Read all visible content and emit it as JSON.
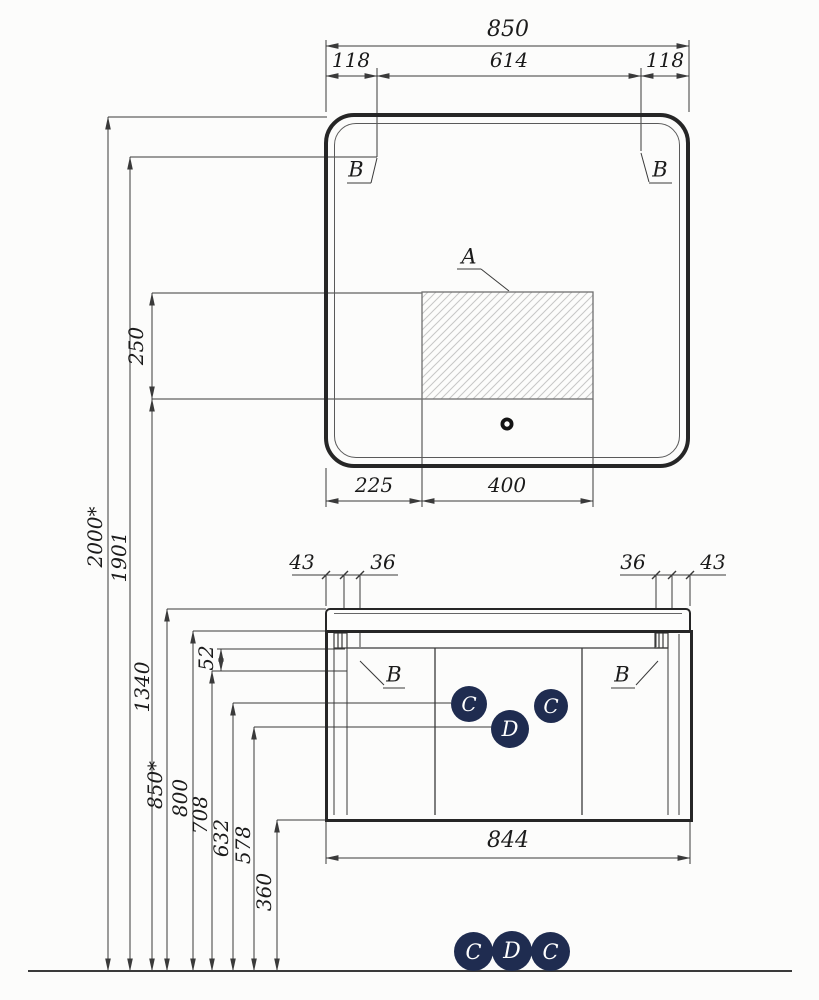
{
  "top_dims": {
    "overall": "850",
    "left": "118",
    "center": "614",
    "right": "118"
  },
  "mirror": {
    "corner_label_left": "B",
    "corner_label_right": "B",
    "zone_label": "A",
    "zone_height": "250",
    "bottom_left": "225",
    "bottom_center": "400"
  },
  "heights": {
    "h2000": "2000*",
    "h1901": "1901",
    "h1340": "1340",
    "h850": "850*",
    "h800": "800",
    "h708": "708",
    "h632": "632",
    "h578": "578",
    "h360": "360",
    "h52": "52"
  },
  "cabinet": {
    "offset_left": "43",
    "bracket_left": "36",
    "bracket_right": "36",
    "offset_right": "43",
    "width": "844",
    "door_label_left": "B",
    "door_label_right": "B",
    "knob_left": "C",
    "knob_center": "D",
    "knob_right": "C"
  },
  "legend": {
    "left": "C",
    "center": "D",
    "right": "C"
  },
  "colors": {
    "line": "#3a3a3a",
    "feature": "#262626",
    "knob_fill": "#1f2c50",
    "knob_text": "#ffffff",
    "hatch": "#c6c6c6"
  }
}
